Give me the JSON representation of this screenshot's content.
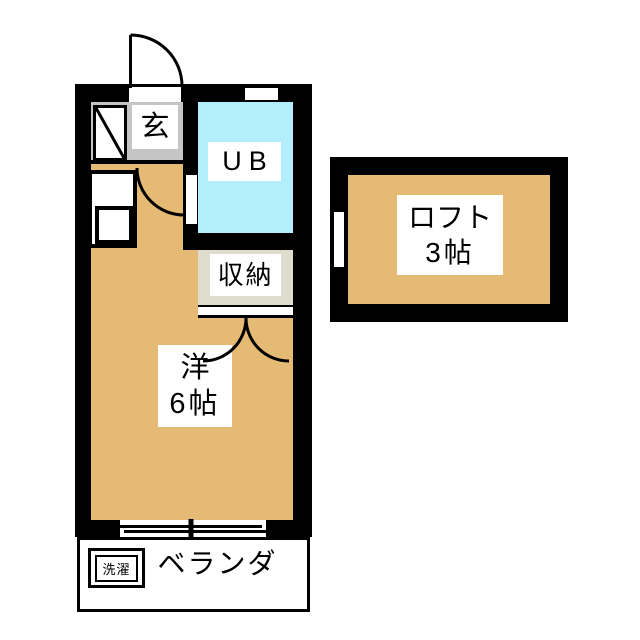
{
  "colors": {
    "wall": "#000000",
    "floor": "#e4ba74",
    "bath": "#b2eefb",
    "entry": "#c5c5c5",
    "closet": "#dedccc",
    "label_bg": "#ffffff",
    "bg": "#ffffff"
  },
  "rooms": {
    "entry": {
      "label": "玄"
    },
    "unit_bath": {
      "label": "UB"
    },
    "closet": {
      "label": "収納"
    },
    "western_room": {
      "label": "洋",
      "size": "6帖"
    },
    "loft": {
      "label": "ロフト",
      "size": "3帖"
    },
    "veranda": {
      "label": "ベランダ"
    },
    "laundry": {
      "label": "洗濯"
    }
  }
}
